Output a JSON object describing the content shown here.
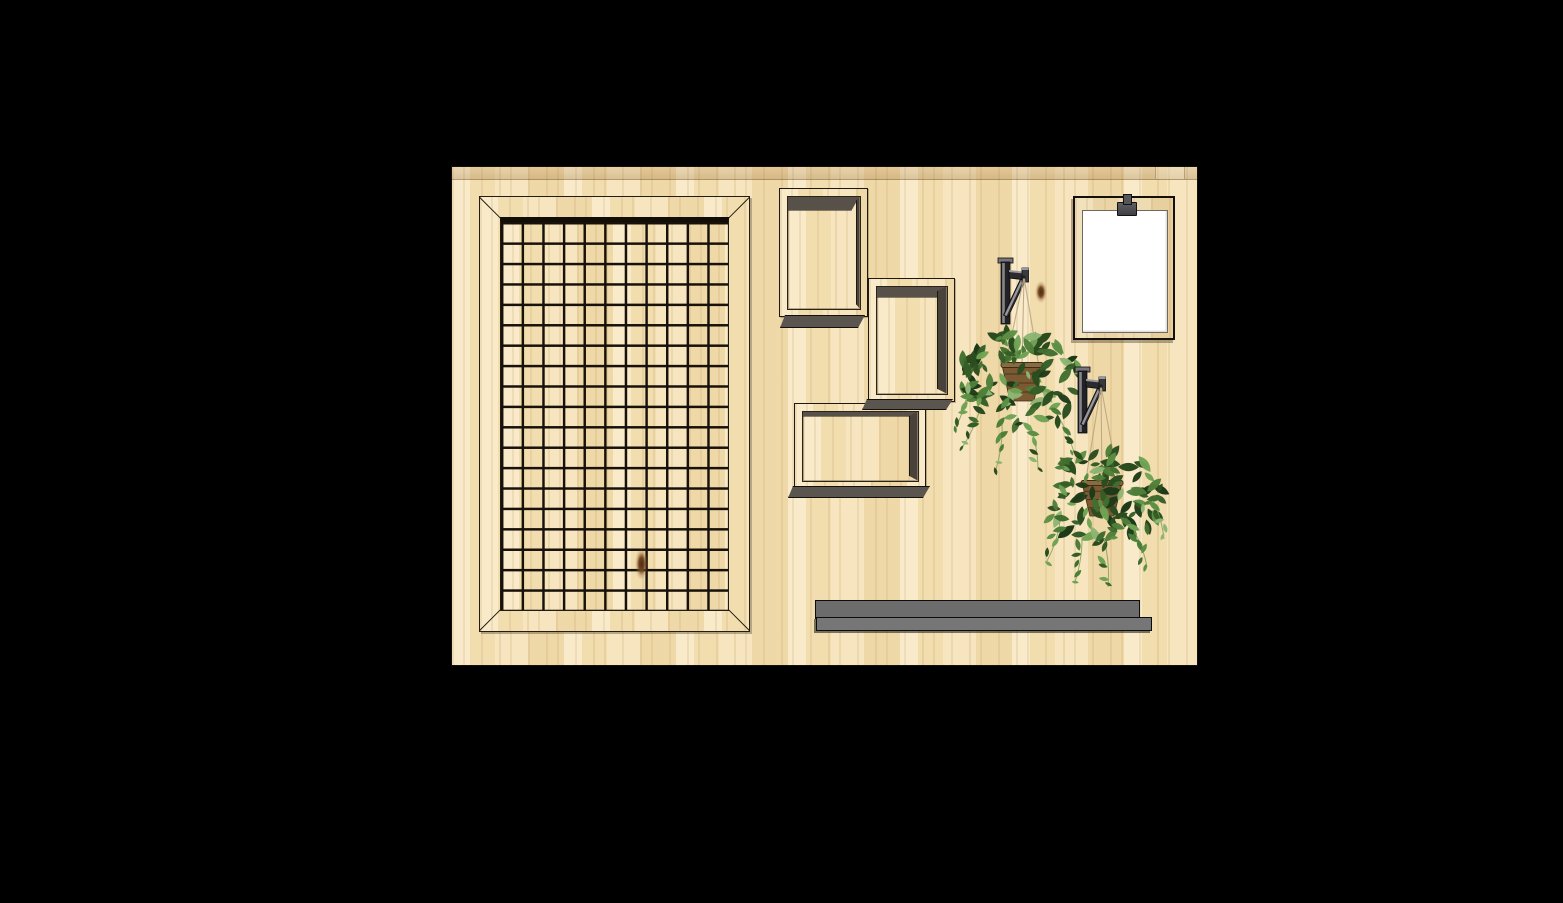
{
  "scene": {
    "background_color": "#000000",
    "inventory": [
      "plywood-wall-board",
      "wire-grid-panel",
      "shadow-box-frame",
      "shadow-box-frame",
      "shadow-box-frame",
      "wall-bracket",
      "wall-bracket",
      "hanging-ivy-basket",
      "hanging-ivy-basket",
      "clipboard-with-blank-paper",
      "wall-ledge-shelf",
      "wood-knot",
      "wood-knot"
    ],
    "panel": {
      "x": 452,
      "y": 167,
      "w": 745,
      "h": 498
    },
    "band": {
      "h": 12
    },
    "grid_frame": {
      "x": 27,
      "y": 29,
      "w": 269,
      "h": 434,
      "cols": 11,
      "rows": 19,
      "wire_color": "#17110a"
    },
    "shadow_boxes": [
      {
        "x": 327,
        "y": 21,
        "w": 87,
        "h": 127,
        "top": 13,
        "right": 3
      },
      {
        "x": 416,
        "y": 111,
        "w": 85,
        "h": 122,
        "top": 10,
        "right": 9
      },
      {
        "x": 342,
        "y": 236,
        "w": 130,
        "h": 84,
        "top": 4,
        "right": 8
      }
    ],
    "bottom_bars": [
      {
        "x": 328,
        "y": 148,
        "w": 84,
        "h": 11
      },
      {
        "x": 410,
        "y": 232,
        "w": 90,
        "h": 9
      },
      {
        "x": 336,
        "y": 319,
        "w": 141,
        "h": 10
      }
    ],
    "clipboard": {
      "x": 621,
      "y": 29,
      "w": 98,
      "h": 140,
      "paper_color": "#ffffff",
      "clip_color": "#4c4c50"
    },
    "shelf": {
      "top": {
        "x": 363,
        "y": 433,
        "w": 323,
        "h": 17
      },
      "bottom": {
        "x": 364,
        "y": 450,
        "w": 334,
        "h": 12
      },
      "color": "#6c6c6c"
    },
    "knots": [
      {
        "x": 134,
        "y": 326,
        "w": 13,
        "h": 32
      },
      {
        "x": 583,
        "y": 114,
        "w": 12,
        "h": 22
      }
    ],
    "plants": [
      {
        "bracket": {
          "x": 549,
          "y": 91
        },
        "hook": {
          "x": 572,
          "y": 110
        },
        "basket": {
          "cx": 570,
          "top": 198,
          "topW": 40,
          "botW": 24,
          "h": 36
        },
        "cluster": {
          "cx": 568,
          "cy": 214,
          "rx": 64,
          "ry": 50,
          "leaves": 78,
          "seed": 7
        },
        "strands": [
          [
            516,
            222,
            502,
            264
          ],
          [
            528,
            242,
            508,
            284
          ],
          [
            550,
            256,
            544,
            302
          ],
          [
            578,
            258,
            586,
            303
          ],
          [
            604,
            246,
            622,
            286
          ]
        ]
      },
      {
        "bracket": {
          "x": 626,
          "y": 200
        },
        "hook": {
          "x": 649,
          "y": 219
        },
        "basket": {
          "cx": 650,
          "top": 316,
          "topW": 40,
          "botW": 24,
          "h": 33
        },
        "cluster": {
          "cx": 651,
          "cy": 330,
          "rx": 61,
          "ry": 47,
          "leaves": 74,
          "seed": 13
        },
        "strands": [
          [
            608,
            354,
            595,
            394
          ],
          [
            630,
            368,
            623,
            415
          ],
          [
            652,
            372,
            656,
            420
          ],
          [
            680,
            360,
            695,
            400
          ],
          [
            700,
            331,
            712,
            372
          ]
        ]
      }
    ],
    "palette": {
      "leaf": [
        "#1f3a18",
        "#2a4c1f",
        "#355d27",
        "#416e30",
        "#4e7f3a",
        "#5c9044",
        "#70a354",
        "#8db574"
      ],
      "stem": "#7fa05f",
      "chain": "#b9a685",
      "basket": "#7b5a33",
      "basket_rim": "#8a6a40",
      "basket_dark": "#3e2d16",
      "bracket_dark": "#222226",
      "bracket_light": "#98989c",
      "bracket_cap": "#77777b",
      "wood_base": "#f1ddb3",
      "depth_top": "#57514a",
      "depth_right": "#48423a",
      "bottom_bar": "#5a554e",
      "shelf": "#6c6c6c",
      "wire": "#17110a"
    }
  }
}
